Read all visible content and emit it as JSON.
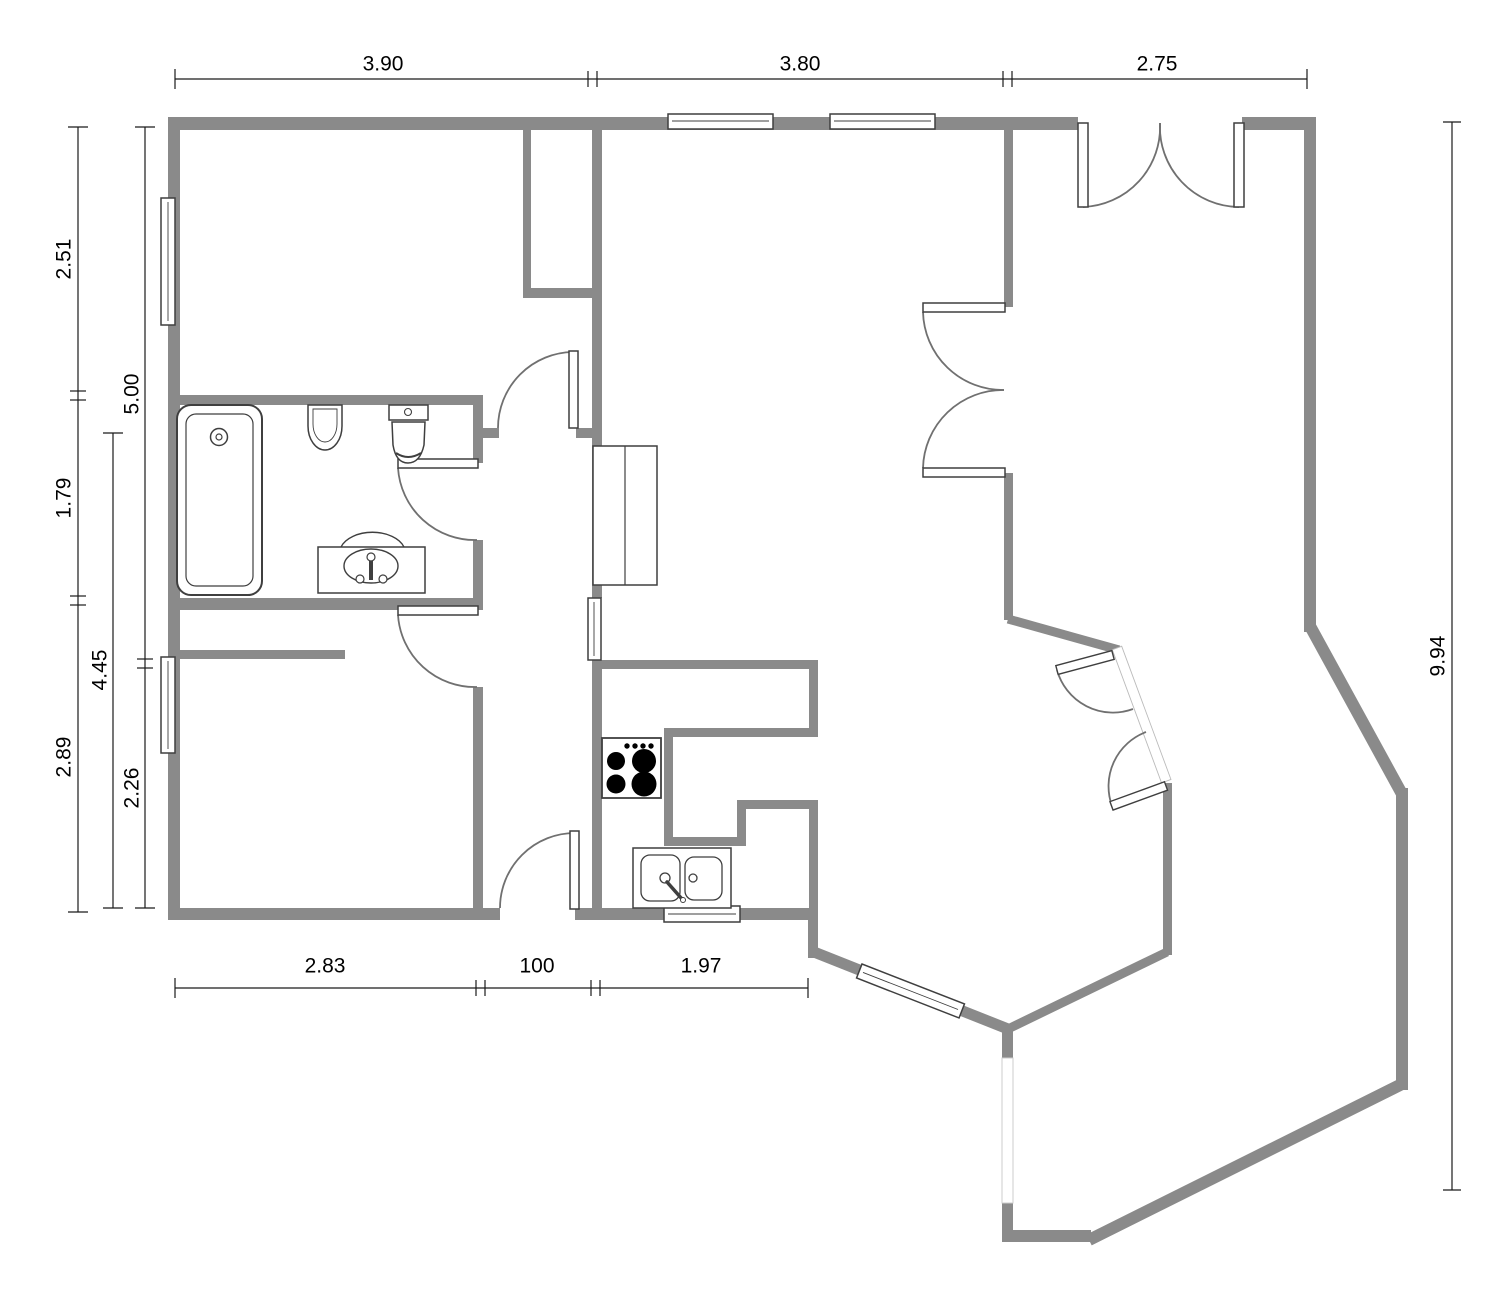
{
  "app": {
    "type": "floor-plan-drawing",
    "background": "#ffffff"
  },
  "colors": {
    "wall": "#8a8a8a",
    "dimension_line": "#1a1a1a",
    "fixture_outline": "#3f3f3f",
    "door_arc": "#707070"
  },
  "dimensions": {
    "top": [
      {
        "label": "3.90"
      },
      {
        "label": "3.80"
      },
      {
        "label": "2.75"
      }
    ],
    "bottom": [
      {
        "label": "2.83"
      },
      {
        "label": "100"
      },
      {
        "label": "1.97"
      }
    ],
    "left_outer": [
      {
        "label": "2.51"
      },
      {
        "label": "1.79"
      },
      {
        "label": "2.89"
      }
    ],
    "left_middle": [
      {
        "label": "4.45"
      }
    ],
    "left_inner": [
      {
        "label": "5.00"
      },
      {
        "label": "2.26"
      }
    ],
    "right": [
      {
        "label": "9.94"
      }
    ]
  },
  "fixtures": [
    "bathtub",
    "bidet",
    "toilet",
    "vanity-sink",
    "wardrobe-cabinet",
    "stove-cooktop",
    "double-basin-sink"
  ],
  "openings": {
    "windows": 7,
    "single_doors": 4,
    "double_doors": 3,
    "wall_openings": 1
  }
}
